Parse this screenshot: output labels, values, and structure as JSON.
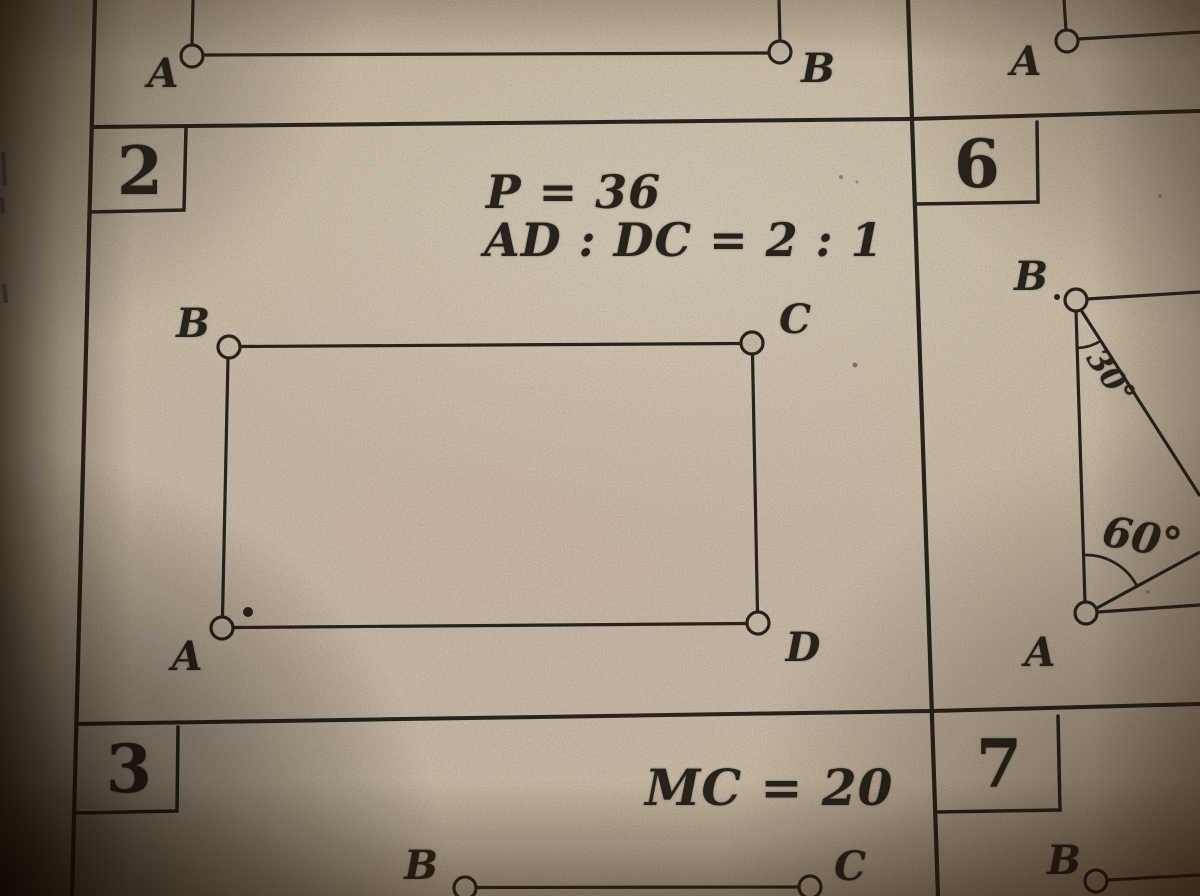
{
  "figure_top_left": {
    "label_a": "A",
    "label_b": "B"
  },
  "figure_top_right": {
    "label_a": "A"
  },
  "problem_2": {
    "number": "2",
    "given_line_1": "P = 36",
    "given_line_2": "AD : DC = 2 : 1",
    "label_b": "B",
    "label_c": "C",
    "label_a": "A",
    "label_d": "D"
  },
  "problem_6": {
    "number": "6",
    "label_b": "B",
    "label_a": "A",
    "angle_at_b": "30°",
    "angle_at_a": "60°"
  },
  "problem_3": {
    "number": "3",
    "given": "MC = 20",
    "label_b": "B",
    "label_c": "C"
  },
  "problem_7": {
    "number": "7",
    "label_b": "B"
  },
  "colors": {
    "paper": "#d7c9b3",
    "ink": "#2d2720",
    "pen_mark_blue": "#5f6f9e"
  }
}
